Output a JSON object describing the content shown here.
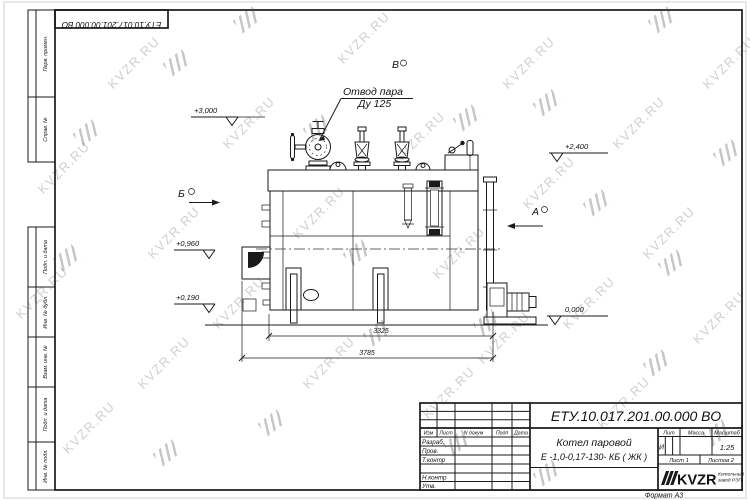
{
  "sheet": {
    "doc_number": "ЕТУ.10.017.201.00.000  ВО",
    "format_label": "Формат А3"
  },
  "margin_labels": [
    "Перв. примен.",
    "Справ. №",
    "Подп. и дата",
    "Инв. № дубл.",
    "Взам. инв. №",
    "Подп. и дата",
    "Инв. № подл."
  ],
  "title_block": {
    "doc_number": "ЕТУ.10.017.201.00.000  ВО",
    "product_name_line1": "Котел паровой",
    "product_name_line2": "Е -1,0-0,17-130- КБ ( ЖК )",
    "cols": {
      "izm": "Изм",
      "list": "Лист",
      "ndoc": "N докум",
      "podp": "Подп",
      "data": "Дата"
    },
    "rows": {
      "razrab": "Разраб.",
      "prov": "Пров.",
      "tkontr": "Т.контр",
      "nkontr": "Н.контр",
      "utv": "Утв."
    },
    "lit_label": "Лит",
    "massa_label": "Масса",
    "masshtab_label": "Масштаб",
    "lit_value": "И",
    "scale_value": "1:25",
    "sheet_info": "Лист 1",
    "sheets_info": "Листов 2",
    "logo_text": "KVZR",
    "logo_sub_line1": "Котельный",
    "logo_sub_line2": "завод РЭП"
  },
  "drawing": {
    "callout_line1": "Отвод пара",
    "callout_line2": "Ду 125",
    "view_labels": {
      "a": "А",
      "b": "Б",
      "v": "В"
    },
    "elevations": {
      "e3000": "+3,000",
      "e2400": "+2,400",
      "e0960": "+0,960",
      "e0190": "+0,190",
      "e0000": "0,000"
    },
    "dimensions": {
      "dim_inner": "3325",
      "dim_outer": "3785"
    }
  },
  "watermark": {
    "text": "KVZR.RU"
  }
}
